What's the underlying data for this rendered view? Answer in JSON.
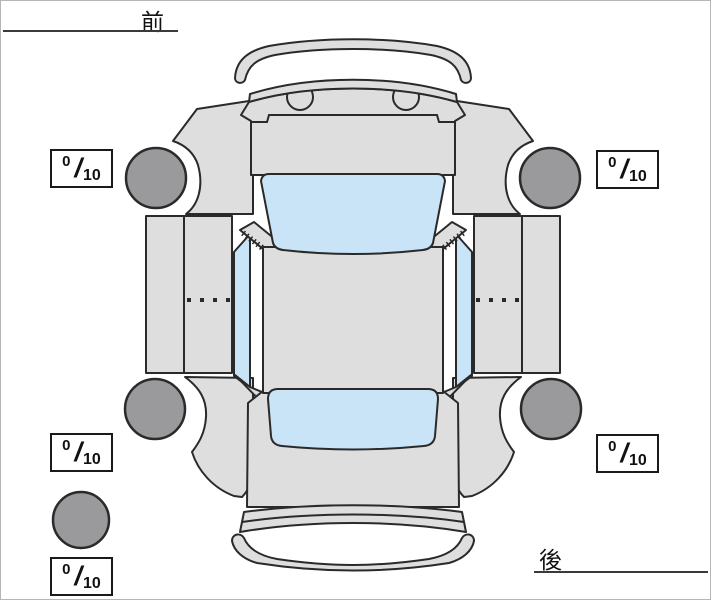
{
  "labels": {
    "front": "前",
    "rear": "後"
  },
  "ratings": {
    "separator": "/",
    "front_left": {
      "value": "0",
      "max": "10"
    },
    "front_right": {
      "value": "0",
      "max": "10"
    },
    "rear_left": {
      "value": "0",
      "max": "10"
    },
    "rear_right": {
      "value": "0",
      "max": "10"
    },
    "spare": {
      "value": "0",
      "max": "10"
    }
  },
  "colors": {
    "background": "#ffffff",
    "body": "#dedede",
    "glass": "#c8e4f6",
    "tire": "#9a9a9c",
    "outline": "#2a2a2a",
    "box_border": "#1a1a1a",
    "text": "#111111"
  }
}
